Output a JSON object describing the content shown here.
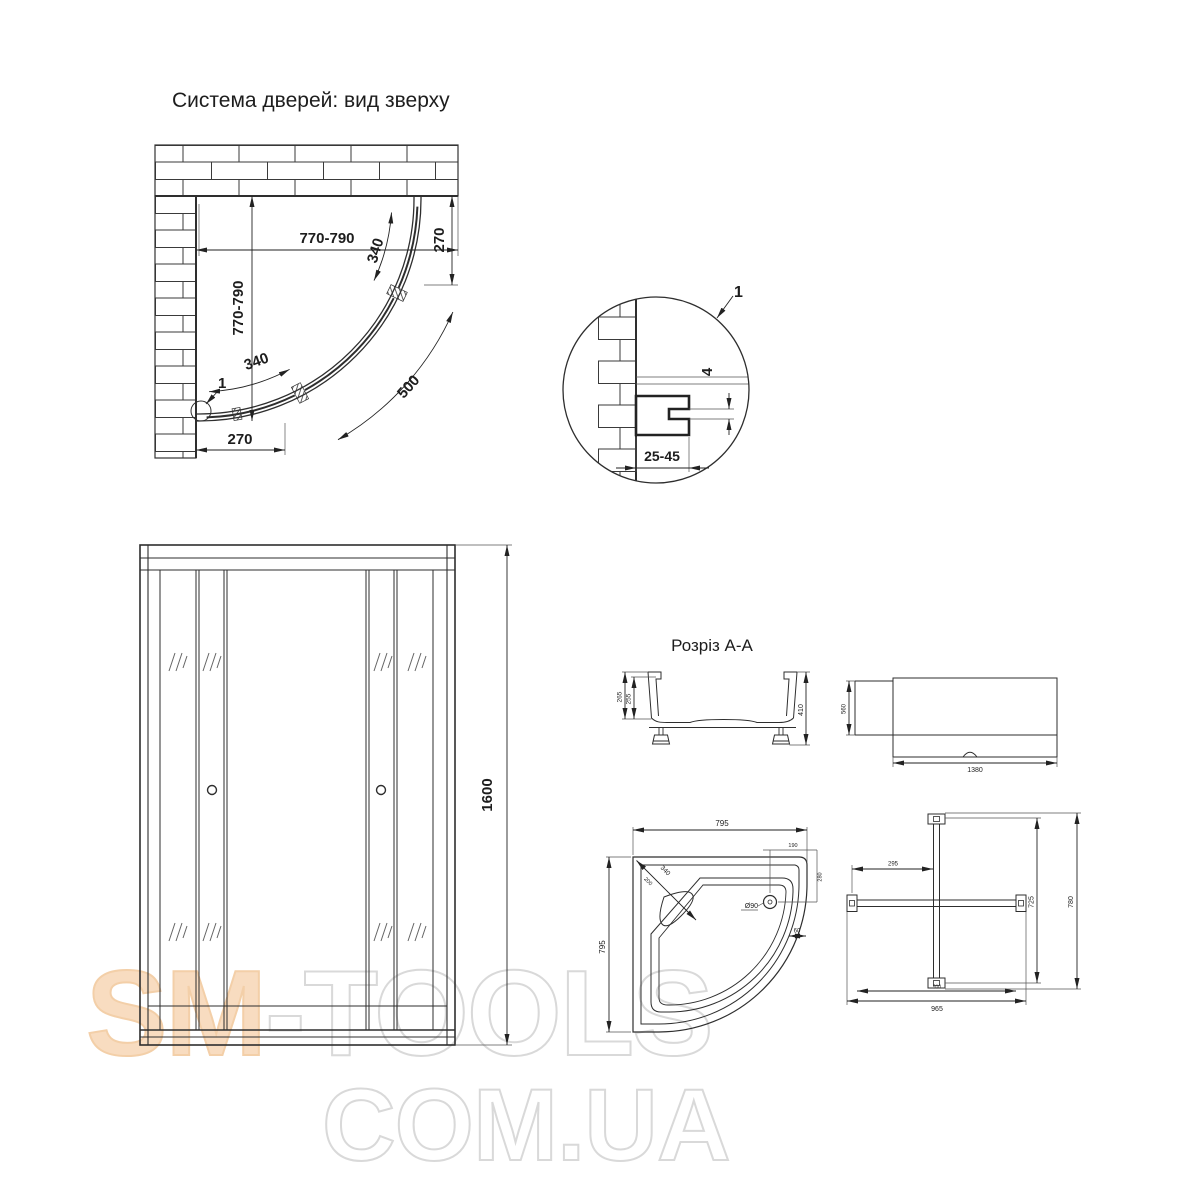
{
  "titles": {
    "main": "Система дверей: вид зверху",
    "section": "Розріз А-А"
  },
  "top_view": {
    "width": "770-790",
    "height": "770-790",
    "right_return": "270",
    "bottom_return": "270",
    "door_top": "340",
    "door_bottom": "340",
    "radius": "500",
    "detail_ref": "1"
  },
  "detail": {
    "ref": "1",
    "width": "25-45",
    "gap": "4"
  },
  "front_view": {
    "height": "1600"
  },
  "section_aa": {
    "outer": "265",
    "inner": "255",
    "total": "410"
  },
  "panel": {
    "height": "560",
    "length": "1380"
  },
  "tray": {
    "width": "795",
    "depth": "795",
    "seat": "340",
    "seat_inner": "200",
    "drain": "Ø90",
    "drain_x": "190",
    "drain_y": "280",
    "rim": "60"
  },
  "profiles": {
    "offset": "295",
    "inner_h": "725",
    "outer_h": "780",
    "inner_w": "910",
    "width": "965"
  },
  "watermark": {
    "brand_left": "SM",
    "brand_right": "-TOOLS",
    "domain": "COM.UA"
  },
  "colors": {
    "line": "#2e2e2e",
    "watermark_peach": "#f8dcc0",
    "watermark_outline": "#d9d9d9"
  }
}
